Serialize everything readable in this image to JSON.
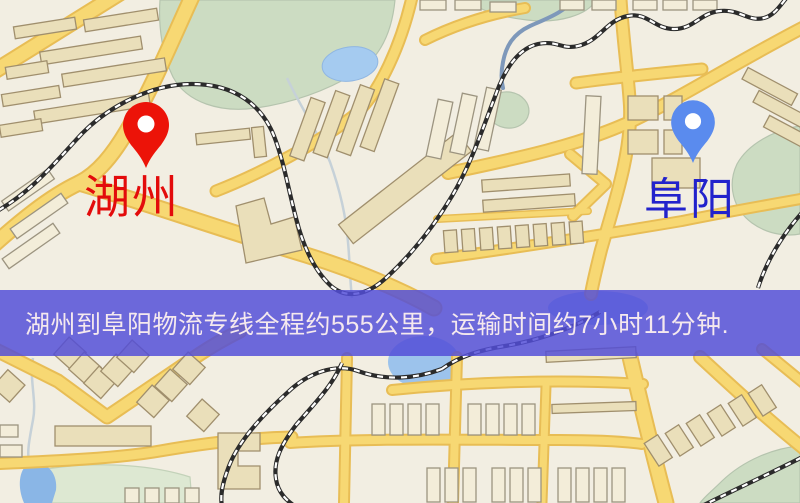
{
  "map": {
    "origin": {
      "name": "湖州",
      "pin_color": "#ec1308",
      "label_color": "#e30b0b"
    },
    "destination": {
      "name": "阜阳",
      "pin_color": "#5a8bee",
      "label_color": "#2222cc"
    },
    "banner": {
      "text": "湖州到阜阳物流专线全程约555公里，运输时间约7小时11分钟.",
      "bg_color": "rgba(82,78,216,0.84)",
      "text_color": "#f5e9ee"
    },
    "route": {
      "distance_text": "约555公里",
      "duration_text": "约7小时11分钟"
    },
    "palette": {
      "land": "#f2eee2",
      "park": "#ccdcc2",
      "water": "#a5cbf0",
      "road_fill": "#f7d873",
      "road_casing": "#e8bd55",
      "railway": "#2b2b2b"
    }
  }
}
